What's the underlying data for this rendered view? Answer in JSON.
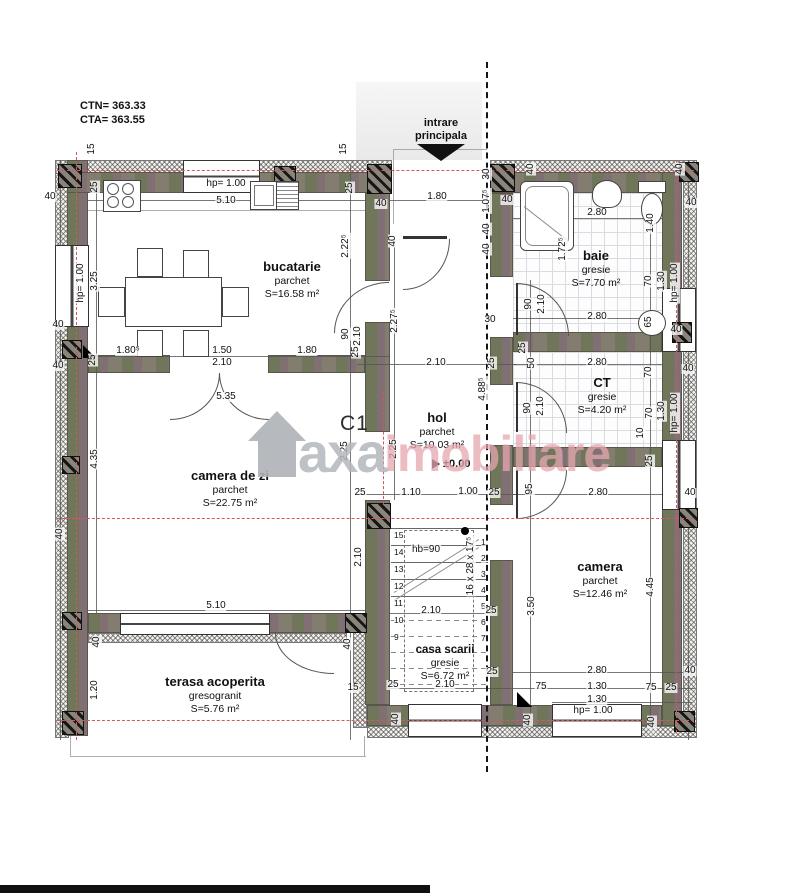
{
  "meta": {
    "ctn": "CTN= 363.33",
    "cta": "CTA= 363.55"
  },
  "entrance": {
    "line1": "intrare",
    "line2": "principala"
  },
  "section_label": "C1",
  "watermark": {
    "brand": "axa",
    "brand2": "imobiliare"
  },
  "rooms": {
    "bucatarie": {
      "name": "bucatarie",
      "finish": "parchet",
      "area": "S=16.58 m²"
    },
    "baie": {
      "name": "baie",
      "finish": "gresie",
      "area": "S=7.70 m²"
    },
    "hol": {
      "name": "hol",
      "finish": "parchet",
      "area": "S=10.03 m²",
      "level": "±0.00"
    },
    "ct": {
      "name": "CT",
      "finish": "gresie",
      "area": "S=4.20 m²"
    },
    "camera_de_zi": {
      "name": "camera de zi",
      "finish": "parchet",
      "area": "S=22.75 m²"
    },
    "camera": {
      "name": "camera",
      "finish": "parchet",
      "area": "S=12.46 m²"
    },
    "casa_scarii": {
      "name": "casa scarii",
      "finish": "gresie",
      "area": "S=6.72 m²"
    },
    "terasa": {
      "name": "terasa acoperita",
      "finish": "gresogranit",
      "area": "S=5.76 m²"
    }
  },
  "stairs": {
    "handrail": "hb=90",
    "spec": "16 x 28 x 17⁵",
    "steps_left": [
      "15",
      "14",
      "13",
      "12",
      "11",
      "10",
      "9"
    ],
    "steps_right": [
      "1",
      "2",
      "3",
      "4",
      "5",
      "6",
      "7"
    ]
  },
  "colors": {
    "wall": "#827d6f",
    "insulation": "#f4f2ee",
    "axis_red": "#d4565f",
    "watermark_gray": "#b3b7bb",
    "watermark_pink": "#e5a7b0"
  },
  "dims": [
    {
      "t": "15",
      "x": 92,
      "y": 149,
      "r": -90
    },
    {
      "t": "40",
      "x": 50,
      "y": 197
    },
    {
      "t": "25",
      "x": 95,
      "y": 187,
      "r": -90
    },
    {
      "t": "hp= 1.00",
      "x": 226,
      "y": 184
    },
    {
      "t": "5.10",
      "x": 226,
      "y": 201
    },
    {
      "t": "15",
      "x": 344,
      "y": 149,
      "r": -90
    },
    {
      "t": "25",
      "x": 350,
      "y": 188,
      "r": -90
    },
    {
      "t": "40",
      "x": 381,
      "y": 204
    },
    {
      "t": "1.80",
      "x": 437,
      "y": 197
    },
    {
      "t": "40",
      "x": 393,
      "y": 241,
      "r": -90
    },
    {
      "t": "30",
      "x": 487,
      "y": 174,
      "r": -90
    },
    {
      "t": "1.07⁵",
      "x": 487,
      "y": 201,
      "r": -90
    },
    {
      "t": "40",
      "x": 487,
      "y": 229,
      "r": -90
    },
    {
      "t": "40",
      "x": 487,
      "y": 249,
      "r": -90
    },
    {
      "t": "40",
      "x": 507,
      "y": 200
    },
    {
      "t": "40",
      "x": 531,
      "y": 169,
      "r": -90
    },
    {
      "t": "40",
      "x": 680,
      "y": 169,
      "r": -90
    },
    {
      "t": "40",
      "x": 691,
      "y": 203
    },
    {
      "t": "1.72⁵",
      "x": 563,
      "y": 249,
      "r": -90
    },
    {
      "t": "2.80",
      "x": 597,
      "y": 213
    },
    {
      "t": "1.40",
      "x": 651,
      "y": 223,
      "r": -90
    },
    {
      "t": "70",
      "x": 649,
      "y": 281,
      "r": -90
    },
    {
      "t": "1.30",
      "x": 662,
      "y": 281,
      "r": -90
    },
    {
      "t": "hp= 1.00",
      "x": 675,
      "y": 283,
      "r": -90
    },
    {
      "t": "90",
      "x": 529,
      "y": 304,
      "r": -90
    },
    {
      "t": "2.10",
      "x": 542,
      "y": 304,
      "r": -90
    },
    {
      "t": "2.80",
      "x": 597,
      "y": 317
    },
    {
      "t": "65",
      "x": 649,
      "y": 322,
      "r": -90
    },
    {
      "t": "40",
      "x": 676,
      "y": 330
    },
    {
      "t": "hp= 1.00",
      "x": 81,
      "y": 283,
      "r": -90
    },
    {
      "t": "3.25",
      "x": 95,
      "y": 281,
      "r": -90
    },
    {
      "t": "2.22⁵",
      "x": 346,
      "y": 246,
      "r": -90
    },
    {
      "t": "40",
      "x": 58,
      "y": 325
    },
    {
      "t": "1.80⁵",
      "x": 128,
      "y": 351
    },
    {
      "t": "1.50",
      "x": 222,
      "y": 351
    },
    {
      "t": "1.80",
      "x": 307,
      "y": 351
    },
    {
      "t": "2.10",
      "x": 222,
      "y": 363
    },
    {
      "t": "25",
      "x": 356,
      "y": 352,
      "r": -90
    },
    {
      "t": "90",
      "x": 346,
      "y": 334,
      "r": -90
    },
    {
      "t": "2.10",
      "x": 358,
      "y": 336,
      "r": -90
    },
    {
      "t": "25",
      "x": 93,
      "y": 360,
      "r": -90
    },
    {
      "t": "40",
      "x": 58,
      "y": 366
    },
    {
      "t": "2.27⁵",
      "x": 395,
      "y": 321,
      "r": -90
    },
    {
      "t": "2.10",
      "x": 436,
      "y": 363
    },
    {
      "t": "25",
      "x": 492,
      "y": 363,
      "r": -90
    },
    {
      "t": "30",
      "x": 490,
      "y": 320
    },
    {
      "t": "4.88⁵",
      "x": 483,
      "y": 389,
      "r": -90
    },
    {
      "t": "2.25",
      "x": 345,
      "y": 451,
      "r": -90
    },
    {
      "t": "2.25",
      "x": 394,
      "y": 449,
      "r": -90
    },
    {
      "t": "25",
      "x": 360,
      "y": 493
    },
    {
      "t": "1.10",
      "x": 411,
      "y": 493
    },
    {
      "t": "1.00",
      "x": 468,
      "y": 492
    },
    {
      "t": "25",
      "x": 494,
      "y": 493
    },
    {
      "t": "95",
      "x": 530,
      "y": 489,
      "r": -90
    },
    {
      "t": "25",
      "x": 523,
      "y": 348,
      "r": -90
    },
    {
      "t": "50",
      "x": 532,
      "y": 363,
      "r": -90
    },
    {
      "t": "2.80",
      "x": 597,
      "y": 363
    },
    {
      "t": "70",
      "x": 649,
      "y": 372,
      "r": -90
    },
    {
      "t": "40",
      "x": 688,
      "y": 369
    },
    {
      "t": "90",
      "x": 528,
      "y": 408,
      "r": -90
    },
    {
      "t": "2.10",
      "x": 541,
      "y": 406,
      "r": -90
    },
    {
      "t": "70",
      "x": 650,
      "y": 413,
      "r": -90
    },
    {
      "t": "1.30",
      "x": 662,
      "y": 411,
      "r": -90
    },
    {
      "t": "hp= 1.00",
      "x": 675,
      "y": 413,
      "r": -90
    },
    {
      "t": "10",
      "x": 641,
      "y": 433,
      "r": -90
    },
    {
      "t": "25",
      "x": 650,
      "y": 461,
      "r": -90
    },
    {
      "t": "2.80",
      "x": 598,
      "y": 493
    },
    {
      "t": "40",
      "x": 690,
      "y": 493
    },
    {
      "t": "3.50",
      "x": 532,
      "y": 606,
      "r": -90
    },
    {
      "t": "4.45",
      "x": 651,
      "y": 587,
      "r": -90
    },
    {
      "t": "2.80",
      "x": 597,
      "y": 671
    },
    {
      "t": "40",
      "x": 690,
      "y": 671
    },
    {
      "t": "75",
      "x": 541,
      "y": 687
    },
    {
      "t": "1.30",
      "x": 597,
      "y": 687
    },
    {
      "t": "75",
      "x": 651,
      "y": 688
    },
    {
      "t": "25",
      "x": 671,
      "y": 688
    },
    {
      "t": "1.30",
      "x": 597,
      "y": 700
    },
    {
      "t": "hp= 1.00",
      "x": 593,
      "y": 711
    },
    {
      "t": "40",
      "x": 528,
      "y": 720,
      "r": -90
    },
    {
      "t": "40",
      "x": 652,
      "y": 722,
      "r": -90
    },
    {
      "t": "hb=90",
      "x": 426,
      "y": 550
    },
    {
      "t": "16 x 28 x 17⁵",
      "x": 471,
      "y": 566,
      "r": -90
    },
    {
      "t": "2.10",
      "x": 431,
      "y": 611
    },
    {
      "t": "25",
      "x": 491,
      "y": 611
    },
    {
      "t": "25",
      "x": 492,
      "y": 672
    },
    {
      "t": "2.10",
      "x": 445,
      "y": 685
    },
    {
      "t": "25",
      "x": 393,
      "y": 685
    },
    {
      "t": "40",
      "x": 396,
      "y": 719,
      "r": -90
    },
    {
      "t": "5.35",
      "x": 226,
      "y": 397
    },
    {
      "t": "4.35",
      "x": 95,
      "y": 459,
      "r": -90
    },
    {
      "t": "2.10",
      "x": 359,
      "y": 557,
      "r": -90
    },
    {
      "t": "5.10",
      "x": 216,
      "y": 606
    },
    {
      "t": "40",
      "x": 97,
      "y": 642,
      "r": -90
    },
    {
      "t": "1.20",
      "x": 95,
      "y": 690,
      "r": -90
    },
    {
      "t": "40",
      "x": 348,
      "y": 644,
      "r": -90
    },
    {
      "t": "15",
      "x": 353,
      "y": 688
    },
    {
      "t": "40",
      "x": 60,
      "y": 534,
      "r": -90
    }
  ]
}
